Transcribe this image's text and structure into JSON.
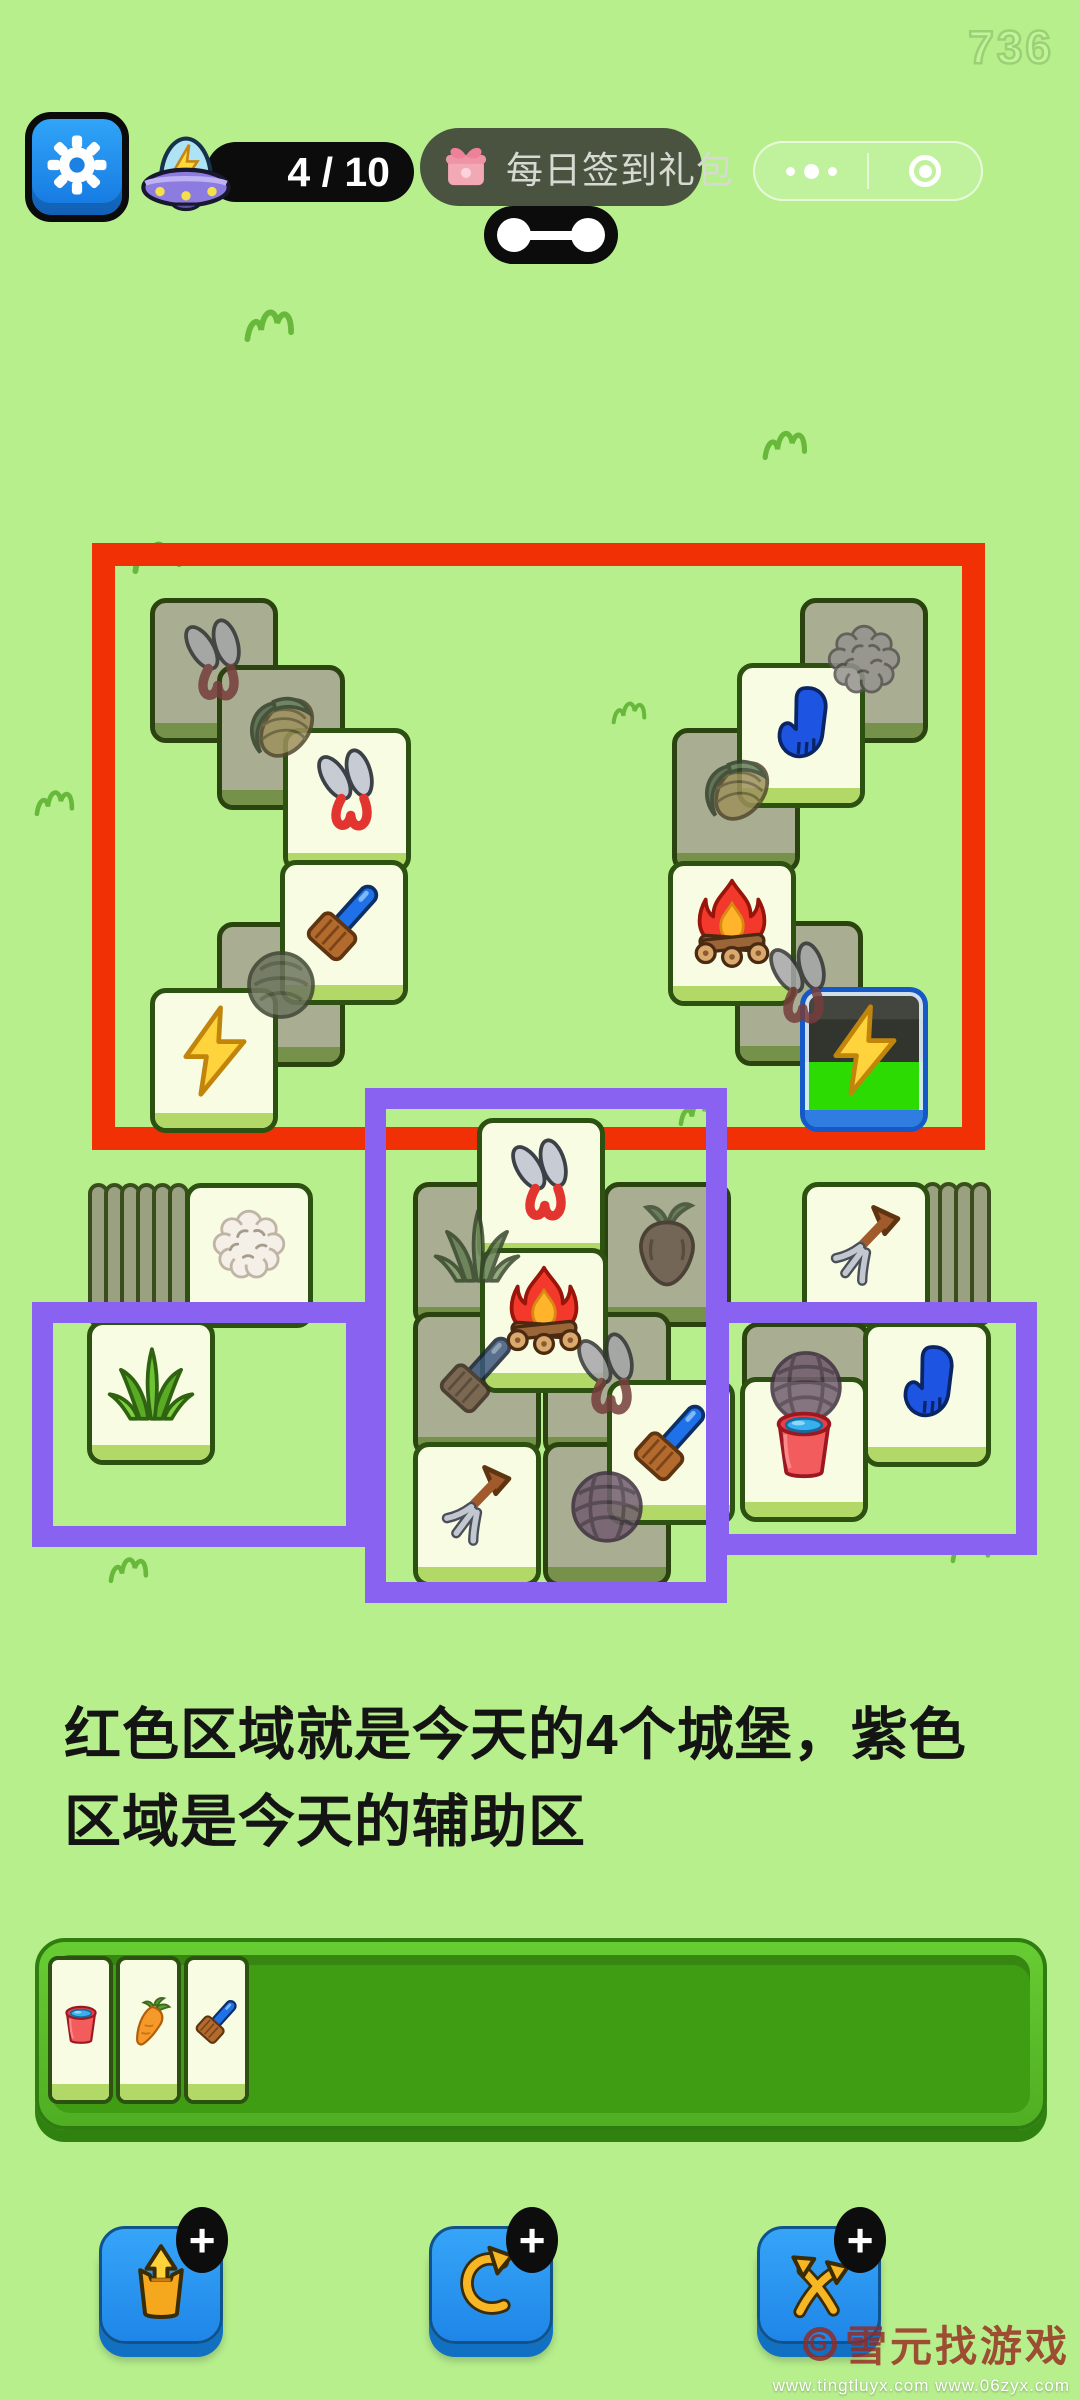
{
  "meta": {
    "score": "736",
    "bg": "#b7ef8d",
    "red_zone_color": "#f23005",
    "purple_zone_color": "#8a62f2"
  },
  "topbar": {
    "counter": "4 / 10",
    "signin_label": "每日签到礼包",
    "capsule": {
      "more_icon": "more-dots-icon",
      "record_icon": "record-circle-icon"
    }
  },
  "caption": {
    "line1": "红色区域就是今天的4个城堡，紫色",
    "line2": "区域是今天的辅助区"
  },
  "zones": [
    {
      "name": "castle-zone-red",
      "color": "#f23005",
      "x": 92,
      "y": 543,
      "w": 893,
      "h": 607,
      "stroke": 23,
      "layer": "under"
    },
    {
      "name": "aux-zone-middle",
      "color": "#8a62f2",
      "x": 365,
      "y": 1088,
      "w": 362,
      "h": 515,
      "stroke": 21,
      "layer": "over"
    },
    {
      "name": "aux-zone-left",
      "color": "#8a62f2",
      "x": 32,
      "y": 1302,
      "w": 335,
      "h": 245,
      "stroke": 21,
      "layer": "over"
    },
    {
      "name": "aux-zone-right",
      "color": "#8a62f2",
      "x": 708,
      "y": 1302,
      "w": 329,
      "h": 253,
      "stroke": 21,
      "layer": "over"
    }
  ],
  "board": {
    "stacks": [
      {
        "icon": "cauliflower",
        "y": 1183,
        "tile_x": 185,
        "edge_x": 88,
        "edges": 6,
        "edge_step": 16
      },
      {
        "icon": "pitchfork",
        "y": 1182,
        "tile_x": 802,
        "edge_x": 922,
        "edges": 4,
        "edge_step": 16
      }
    ],
    "tiles": [
      {
        "icon": "shears",
        "state": "dim",
        "x": 150,
        "y": 598
      },
      {
        "icon": "corn",
        "state": "dim",
        "x": 217,
        "y": 665
      },
      {
        "icon": "shears",
        "state": "bright",
        "x": 283,
        "y": 728
      },
      {
        "icon": "cabbage",
        "state": "dim",
        "x": 217,
        "y": 922
      },
      {
        "icon": "brush",
        "state": "bright",
        "x": 280,
        "y": 860
      },
      {
        "icon": "lightning",
        "state": "bright",
        "x": 150,
        "y": 988
      },
      {
        "icon": "wool",
        "state": "dim",
        "x": 800,
        "y": 598
      },
      {
        "icon": "corn",
        "state": "dim",
        "x": 672,
        "y": 728
      },
      {
        "icon": "glove",
        "state": "bright",
        "x": 737,
        "y": 663
      },
      {
        "icon": "shears",
        "state": "dim",
        "x": 735,
        "y": 921
      },
      {
        "icon": "campfire",
        "state": "bright",
        "x": 668,
        "y": 861
      },
      {
        "icon": "lightning",
        "state": "special",
        "x": 800,
        "y": 987
      },
      {
        "icon": "grass",
        "state": "dim",
        "x": 413,
        "y": 1182
      },
      {
        "icon": "turnip",
        "state": "dim",
        "x": 603,
        "y": 1182
      },
      {
        "icon": "shears",
        "state": "bright",
        "x": 477,
        "y": 1118
      },
      {
        "icon": "brush",
        "state": "dim",
        "x": 413,
        "y": 1312
      },
      {
        "icon": "shears",
        "state": "dim",
        "x": 543,
        "y": 1312
      },
      {
        "icon": "campfire",
        "state": "bright",
        "x": 480,
        "y": 1248
      },
      {
        "icon": "yarn",
        "state": "dim",
        "x": 543,
        "y": 1442
      },
      {
        "icon": "pitchfork",
        "state": "bright",
        "x": 413,
        "y": 1442
      },
      {
        "icon": "brush",
        "state": "bright",
        "x": 607,
        "y": 1380
      },
      {
        "icon": "grass",
        "state": "bright",
        "x": 87,
        "y": 1320
      },
      {
        "icon": "yarn",
        "state": "dim",
        "x": 742,
        "y": 1322
      },
      {
        "icon": "glove",
        "state": "bright",
        "x": 863,
        "y": 1322
      },
      {
        "icon": "bucket",
        "state": "bright",
        "x": 740,
        "y": 1377
      }
    ]
  },
  "slotbar": {
    "x0": 48,
    "step": 68,
    "y": 1956,
    "tiles": [
      "bucket",
      "carrot",
      "brush"
    ]
  },
  "buttons": [
    {
      "name": "popout",
      "icon": "popout-icon",
      "badge": "+",
      "x": 99
    },
    {
      "name": "undo",
      "icon": "undo-icon",
      "badge": "+",
      "x": 429
    },
    {
      "name": "shuffle",
      "icon": "shuffle-icon",
      "badge": "+",
      "x": 757
    }
  ],
  "watermark": {
    "logo_letter": "G",
    "logo": "雪元找游戏",
    "urls": "www.tingtluyx.com  www.06zyx.com"
  },
  "doodles": [
    {
      "x": 240,
      "y": 300,
      "s": 1.0
    },
    {
      "x": 755,
      "y": 420,
      "s": 0.9
    },
    {
      "x": 128,
      "y": 532,
      "s": 1.0
    },
    {
      "x": 598,
      "y": 688,
      "s": 0.7
    },
    {
      "x": 24,
      "y": 778,
      "s": 0.8
    },
    {
      "x": 668,
      "y": 1088,
      "s": 0.8
    },
    {
      "x": 848,
      "y": 1082,
      "s": 0.55
    },
    {
      "x": 98,
      "y": 1545,
      "s": 0.8
    },
    {
      "x": 940,
      "y": 1525,
      "s": 0.8
    }
  ]
}
